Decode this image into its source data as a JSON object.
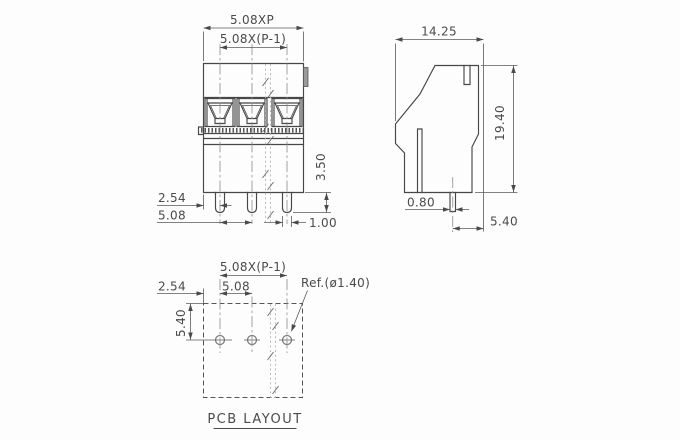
{
  "drawing": {
    "line_color": "#474747",
    "text_color": "#4a4a4a",
    "front_view": {
      "dim_total_pitch": "5.08XP",
      "dim_span": "5.08X(P-1)",
      "dim_edge_offset": "2.54",
      "dim_pitch": "5.08",
      "dim_pin_length": "3.50",
      "dim_pin_width": "1.00"
    },
    "side_view": {
      "dim_depth": "14.25",
      "dim_height": "19.40",
      "dim_pin_thickness": "0.80",
      "dim_pin_to_edge": "5.40"
    },
    "pcb_layout": {
      "dim_span": "5.08X(P-1)",
      "dim_edge_offset": "2.54",
      "dim_pitch": "5.08",
      "dim_row_offset": "5.40",
      "hole_reference": "Ref.(ø1.40)",
      "caption": "PCB LAYOUT"
    }
  }
}
